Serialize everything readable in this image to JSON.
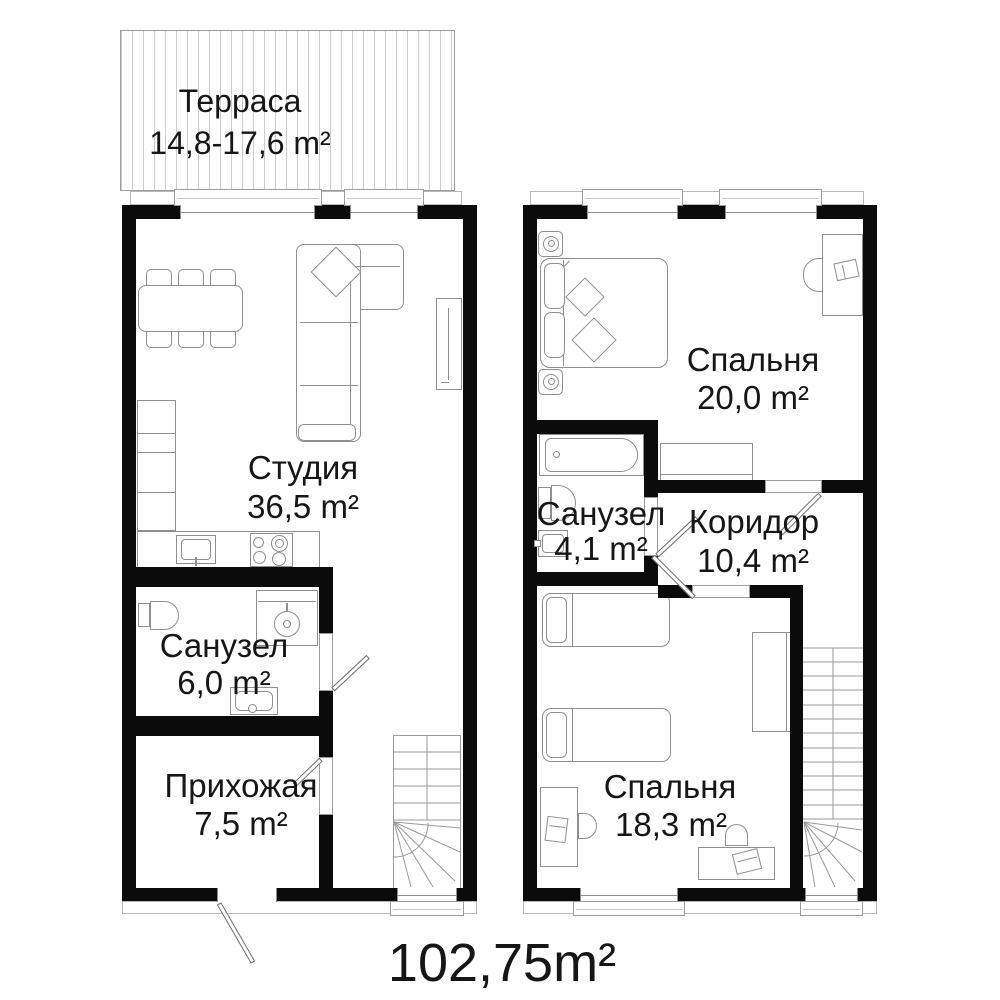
{
  "plan": {
    "total_area": "102,75m²",
    "floor1": {
      "terrace": {
        "name": "Терраса",
        "area": "14,8-17,6 m²"
      },
      "studio": {
        "name": "Студия",
        "area": "36,5 m²"
      },
      "bathroom": {
        "name": "Санузел",
        "area": "6,0 m²"
      },
      "hallway": {
        "name": "Прихожая",
        "area": "7,5 m²"
      }
    },
    "floor2": {
      "bedroom_main": {
        "name": "Спальня",
        "area": "20,0 m²"
      },
      "bathroom": {
        "name": "Санузел",
        "area": "4,1 m²"
      },
      "corridor": {
        "name": "Коридор",
        "area": "10,4 m²"
      },
      "bedroom_second": {
        "name": "Спальня",
        "area": "18,3 m²"
      }
    }
  }
}
